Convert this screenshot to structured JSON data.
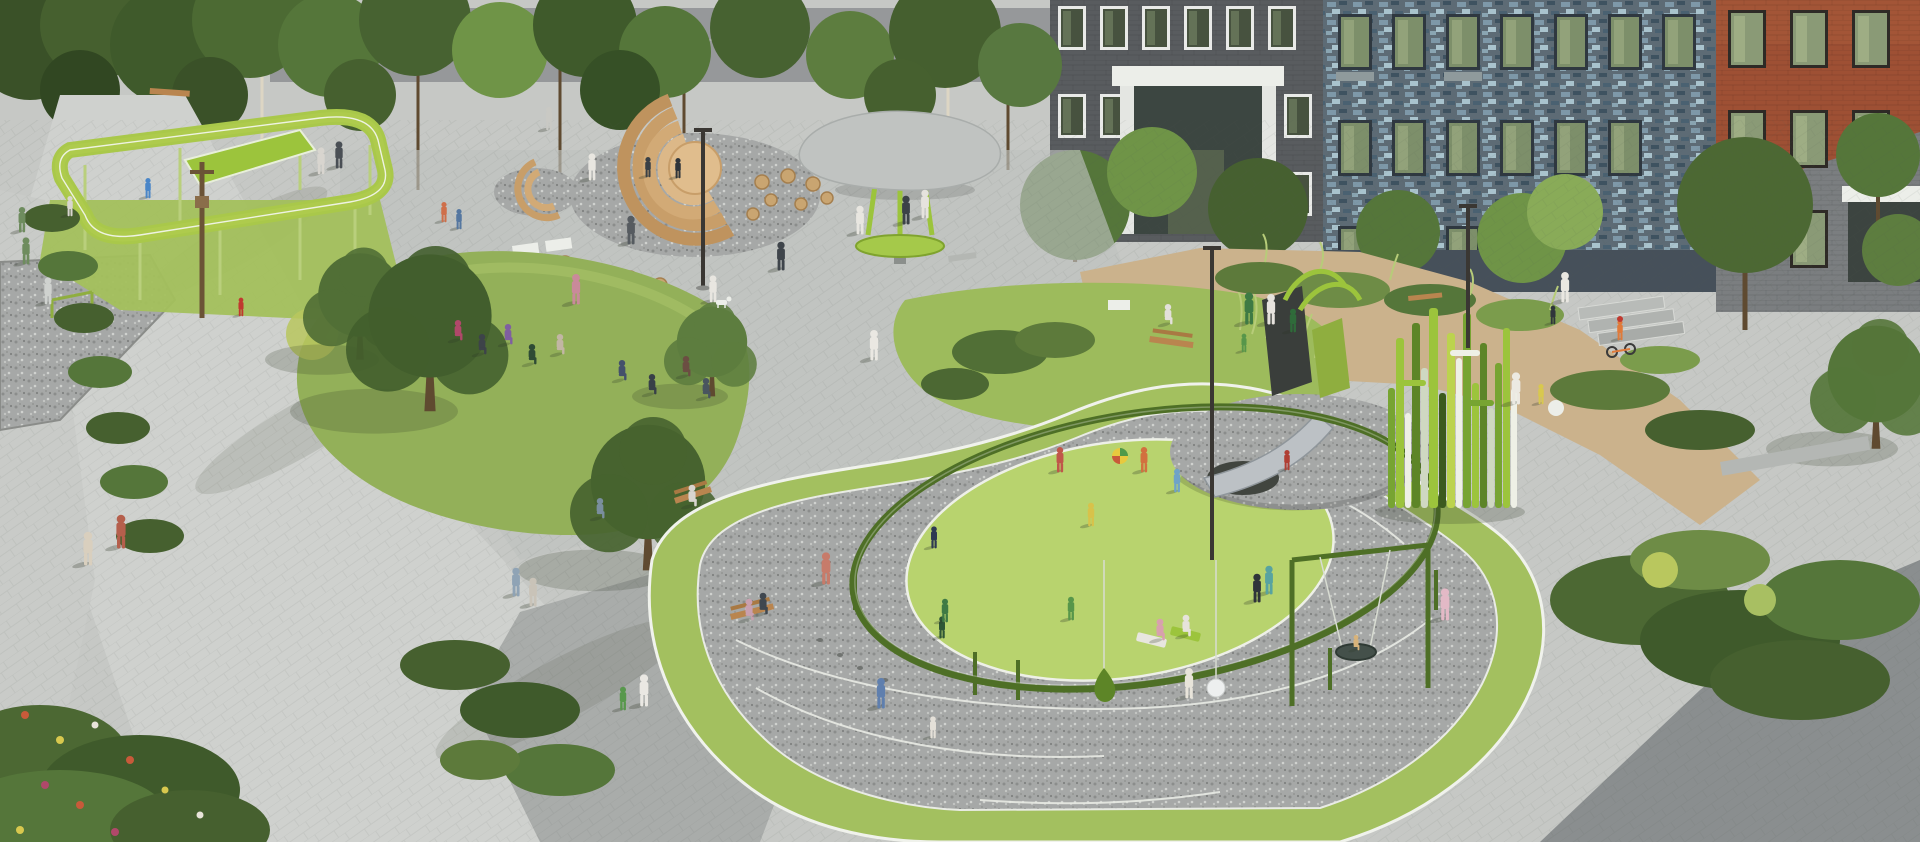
{
  "scene": {
    "type": "architectural-rendering",
    "caption": "Aerial architectural rendering of a residential courtyard park: pedestrian promenade, elevated green ropes course, wooden amphitheater steps, mushroom canopy pavilion, central lawn with a yoga group, kidney-shaped playground with gravel running loop, circular green rail, hill slide, nest swing, grass-blade climbing sculpture, sand play area, and apartment buildings with dark brick, blue mosaic and red brick facades.",
    "elements": [
      "elevated ropes course",
      "wooden amphitheater steps",
      "mushroom canopy pavilion",
      "central lawn with yoga group",
      "playground with circular green rail",
      "gravel running loop",
      "hill slide with steel chute",
      "nest swing and sphere swing",
      "grass-blade climbing sculpture",
      "sand play area with benches",
      "apartment buildings",
      "pedestrian promenade with walking people"
    ]
  },
  "palette": {
    "pavement": "#c6c8c5",
    "promenade": "#cfd1ce",
    "plaza": "#bfc1bf",
    "branch_path": "#a9acaa",
    "plaza_dark": "#8a8e8f",
    "sand": "#cbb28c",
    "lawn": "#93b059",
    "lawn_mound": "#9dbb5c",
    "rubber_green": "#a3c05f",
    "turf_bright": "#b8d36e",
    "ring_green": "#4e6f26",
    "structure_green": "#aecb4d",
    "building_dark": "#595c5f",
    "mosaic_blue": "#7e98a8",
    "brick_red": "#9e5034",
    "canopy_gray": "#c0c3c1",
    "wood": "#d2a977",
    "gravel": "#a6a8a7",
    "tree_dark": "#3f5a2b",
    "tree_mid": "#55763a",
    "tree_light": "#7b9c4c",
    "white_line": "#eef0e8",
    "trunk": "#6b5336"
  }
}
